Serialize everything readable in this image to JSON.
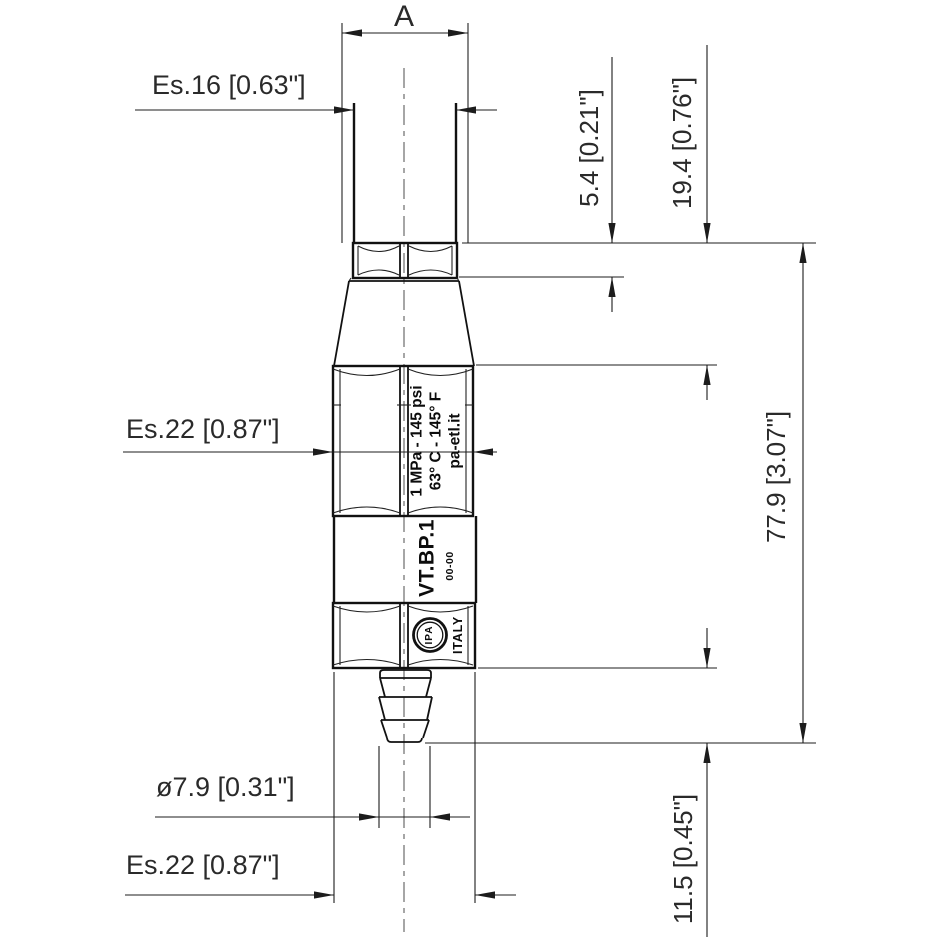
{
  "drawing": {
    "type": "technical-dimension-drawing",
    "part": "hose barb fitting",
    "line_color": "#1c1c1c",
    "background": "#ffffff",
    "dimensions": {
      "thread_diameter": "A",
      "stem_hex": "Es.16 [0.63\"]",
      "body_hex": "Es.22 [0.87\"]",
      "nut_height": "5.4 [0.21\"]",
      "upper_section_height": "19.4 [0.76\"]",
      "overall_length": "77.9 [3.07\"]",
      "barb_diameter": "ø7.9 [0.31\"]",
      "bottom_hex": "Es.22 [0.87\"]",
      "barb_length": "11.5 [0.45\"]"
    },
    "markings": {
      "pressure_rating": "1 MPa - 145 psi",
      "temperature_rating": "63° C - 145° F",
      "website": "pa-etl.it",
      "model": "VT.BP.1",
      "date_code": "00-00",
      "logo_text": "IPA",
      "country": "ITALY"
    }
  }
}
